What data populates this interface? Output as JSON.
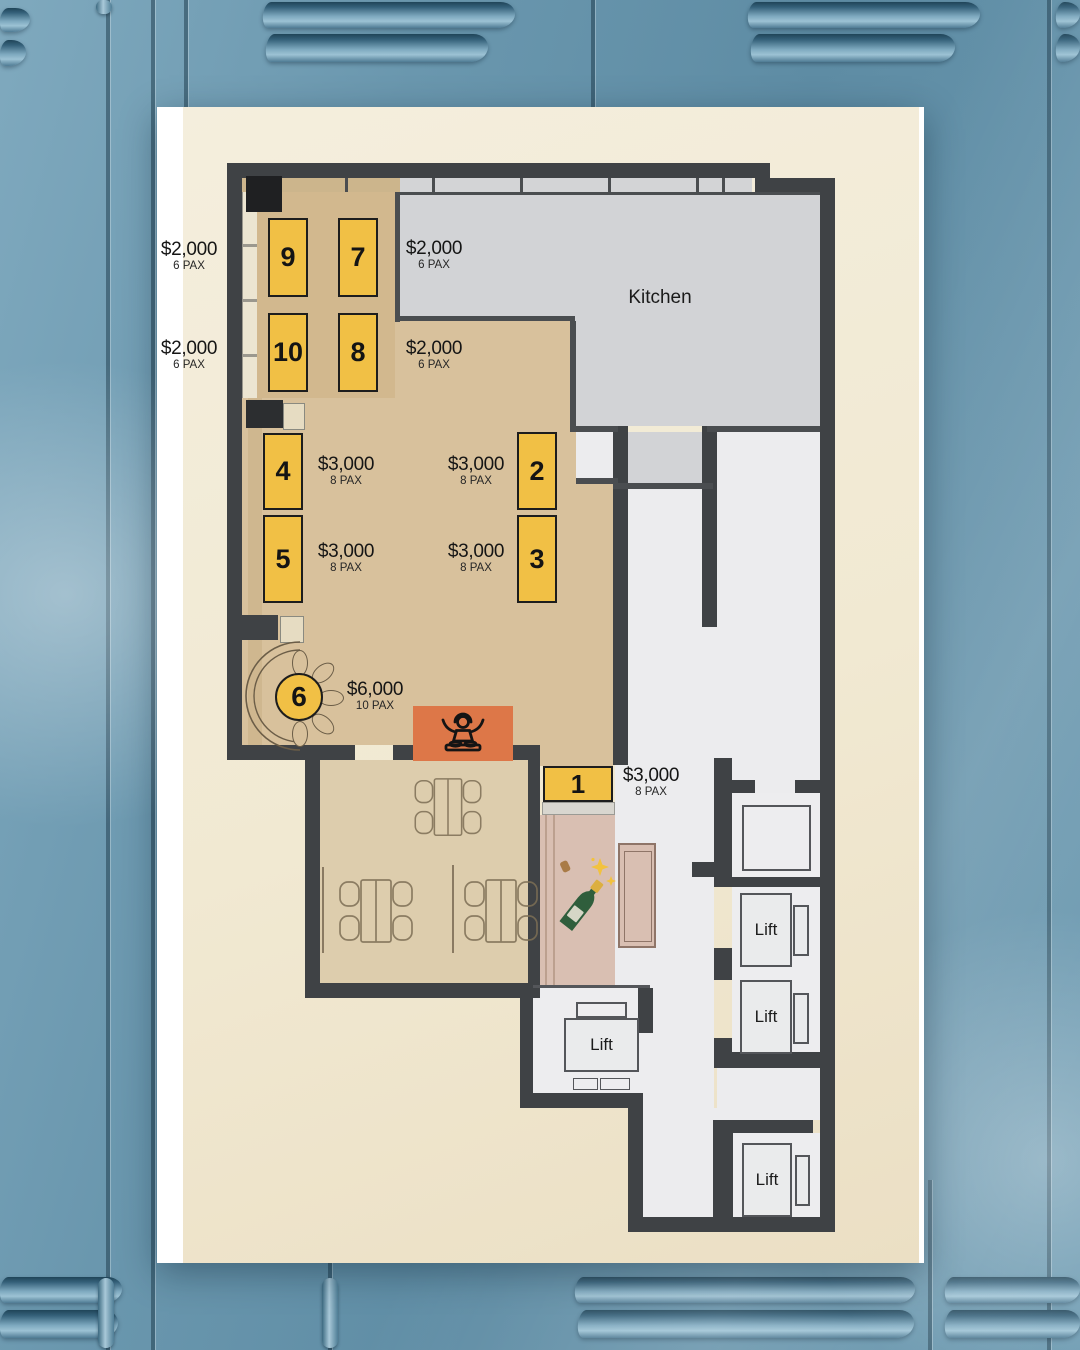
{
  "plan": {
    "kitchen_label": "Kitchen",
    "tables": [
      {
        "id": "table-9",
        "number": "9"
      },
      {
        "id": "table-7",
        "number": "7"
      },
      {
        "id": "table-10",
        "number": "10"
      },
      {
        "id": "table-8",
        "number": "8"
      },
      {
        "id": "table-4",
        "number": "4"
      },
      {
        "id": "table-5",
        "number": "5"
      },
      {
        "id": "table-2",
        "number": "2"
      },
      {
        "id": "table-3",
        "number": "3"
      },
      {
        "id": "table-6",
        "number": "6"
      },
      {
        "id": "table-1",
        "number": "1"
      }
    ],
    "price_labels": [
      {
        "price": "$2,000",
        "pax": "6 PAX"
      },
      {
        "price": "$2,000",
        "pax": "6 PAX"
      },
      {
        "price": "$2,000",
        "pax": "6 PAX"
      },
      {
        "price": "$2,000",
        "pax": "6 PAX"
      },
      {
        "price": "$3,000",
        "pax": "8 PAX"
      },
      {
        "price": "$3,000",
        "pax": "8 PAX"
      },
      {
        "price": "$3,000",
        "pax": "8 PAX"
      },
      {
        "price": "$3,000",
        "pax": "8 PAX"
      },
      {
        "price": "$6,000",
        "pax": "10 PAX"
      },
      {
        "price": "$3,000",
        "pax": "8 PAX"
      }
    ],
    "lifts": [
      {
        "label": "Lift"
      },
      {
        "label": "Lift"
      },
      {
        "label": "Lift"
      },
      {
        "label": "Lift"
      }
    ],
    "icons": [
      {
        "name": "dj-booth-icon"
      },
      {
        "name": "champagne-bottle-icon"
      }
    ],
    "colors": {
      "table_yellow": "#f1c045",
      "dj_orange": "#dd7748",
      "wall_dark": "#3f4245",
      "kitchen_gray": "#d2d3d6",
      "corridor_gray": "#ececee",
      "main_tan": "#d8c19c",
      "platform_tan": "#d2b88e",
      "dining_tan": "#ddcdad",
      "pink_corridor": "#d9bfb2",
      "card_cream": "#f1ead5"
    }
  }
}
